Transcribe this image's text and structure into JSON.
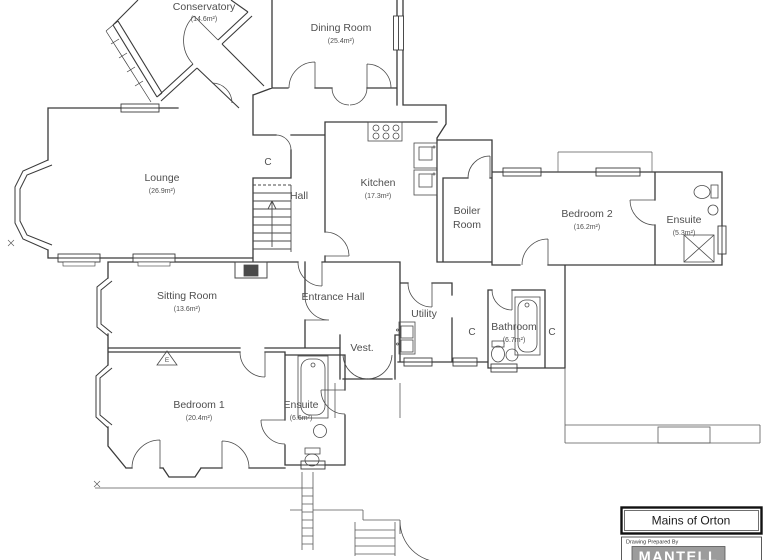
{
  "floor_plan": {
    "rooms": [
      {
        "id": "conservatory",
        "name": "Conservatory",
        "area": "(14.6m²)"
      },
      {
        "id": "dining-room",
        "name": "Dining Room",
        "area": "(25.4m²)"
      },
      {
        "id": "lounge",
        "name": "Lounge",
        "area": "(26.9m²)"
      },
      {
        "id": "hall",
        "name": "Hall",
        "area": ""
      },
      {
        "id": "kitchen",
        "name": "Kitchen",
        "area": "(17.3m²)"
      },
      {
        "id": "boiler-room",
        "name_lines": [
          "Boiler",
          "Room"
        ]
      },
      {
        "id": "bedroom-2",
        "name": "Bedroom 2",
        "area": "(16.2m²)"
      },
      {
        "id": "ensuite-2",
        "name": "Ensuite",
        "area": "(5.3m²)"
      },
      {
        "id": "sitting-room",
        "name": "Sitting Room",
        "area": "(13.6m²)"
      },
      {
        "id": "entrance-hall",
        "name": "Entrance Hall",
        "area": ""
      },
      {
        "id": "utility",
        "name": "Utility",
        "area": ""
      },
      {
        "id": "bathroom",
        "name": "Bathroom",
        "area": "(6.7m²)"
      },
      {
        "id": "bedroom-1",
        "name": "Bedroom 1",
        "area": "(20.4m²)"
      },
      {
        "id": "ensuite-1",
        "name": "Ensuite",
        "area": "(6.6m²)"
      },
      {
        "id": "vestibule",
        "name": "Vest.",
        "area": ""
      }
    ],
    "symbols": {
      "cupboard": "C",
      "fireplace": "E"
    },
    "title_block": {
      "site_name": "Mains of Orton",
      "prepared_by": "Drawing Prepared By",
      "company": "MANTELL"
    },
    "colors": {
      "wall": "#3a3a3a",
      "label": "#4f4f4f",
      "logo_bg": "#9c9c9c",
      "logo_text": "#ffffff"
    }
  }
}
